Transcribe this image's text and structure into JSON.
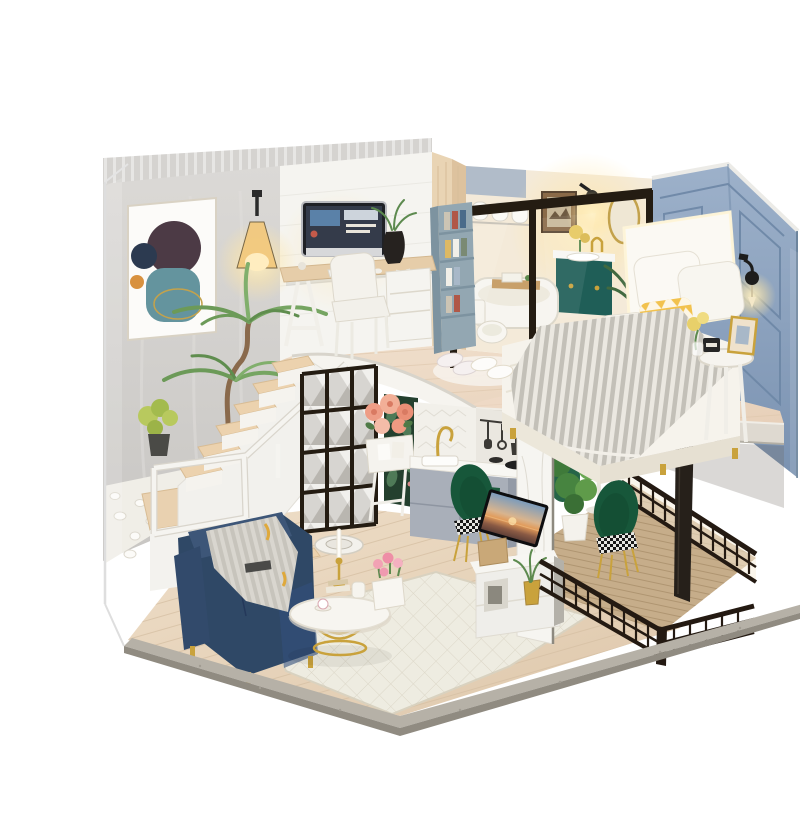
{
  "meta": {
    "domain": "natural-image",
    "subject": "Product photo of a DIY miniature dollhouse: modern two-story loft diorama with living room, kitchen, balcony, stairs, study, bathroom and bedroom, inside a clear acrylic display case on a white background",
    "background": "#ffffff"
  },
  "palette": {
    "background": "#ffffff",
    "wall_gray": "#d3d1ce",
    "wall_white": "#f5f4f0",
    "wall_wood": "#e9d4b4",
    "wall_blue": "#8099b8",
    "floor_wood_upper": "#ecd9c6",
    "floor_wood_lower": "#e6d2ba",
    "fascia_white": "#f6f4ef",
    "sofa_navy": "#2f4866",
    "vanity_teal": "#1f5e57",
    "chair_green": "#17573a",
    "metal_gold": "#c9a23c",
    "lattice_black": "#241c12",
    "railing_black": "#241a12",
    "lamp_glow": "#ffe6a6",
    "blanket_gray": "#b9b6ae",
    "pillow_yellow": "#f2c24e",
    "plant_green": "#6c9a58",
    "rug_cream": "#eeece1",
    "rose_pink": "#f2af97",
    "tulip_pink": "#f2a2b4",
    "deck_wood": "#c6ad8a",
    "base_gray": "#b6b1a7",
    "tv_sky": "#7d9cbb",
    "tv_sunset": "#e29a58"
  },
  "rooms": {
    "upper": [
      "study",
      "bathroom",
      "bedroom"
    ],
    "lower": [
      "living-room",
      "kitchen",
      "dining-balcony",
      "stair-garden"
    ]
  },
  "objects": [
    {
      "id": "acrylic-cover",
      "label": "clear acrylic dust cover"
    },
    {
      "id": "left-wall",
      "label": "gray textured wall"
    },
    {
      "id": "wall-art",
      "label": "abstract framed art"
    },
    {
      "id": "wall-lamp-left",
      "label": "glowing wall lamp"
    },
    {
      "id": "study-desk",
      "label": "trestle desk"
    },
    {
      "id": "imac",
      "label": "desktop computer"
    },
    {
      "id": "desk-chair",
      "label": "white upholstered chair"
    },
    {
      "id": "bookshelf",
      "label": "open bookshelf"
    },
    {
      "id": "bathroom",
      "label": "glass partition bathroom"
    },
    {
      "id": "bathtub",
      "label": "white bathtub with tray"
    },
    {
      "id": "toilet",
      "label": "toilet"
    },
    {
      "id": "vanity",
      "label": "teal floating vanity"
    },
    {
      "id": "mirror",
      "label": "gold framed mirror"
    },
    {
      "id": "blue-wall",
      "label": "slate blue panel wall"
    },
    {
      "id": "bed",
      "label": "white platform bed"
    },
    {
      "id": "knit-blanket",
      "label": "gray knitted throw"
    },
    {
      "id": "pillows",
      "label": "white and yellow pillows"
    },
    {
      "id": "side-table",
      "label": "round bedside table"
    },
    {
      "id": "slippers",
      "label": "fluffy slippers"
    },
    {
      "id": "stairs",
      "label": "open wooden staircase"
    },
    {
      "id": "landing-railing",
      "label": "white stair railing"
    },
    {
      "id": "pebble-garden",
      "label": "white pebble indoor garden"
    },
    {
      "id": "yucca-plant",
      "label": "tall green plant"
    },
    {
      "id": "lattice-screen",
      "label": "black lattice mirror screen"
    },
    {
      "id": "flower-stand",
      "label": "rose flower stand"
    },
    {
      "id": "leaf-panel",
      "label": "tropical leaf wallpaper panel"
    },
    {
      "id": "kitchen",
      "label": "gray kitchen with gold faucet"
    },
    {
      "id": "marble-partition",
      "label": "white marble TV wall"
    },
    {
      "id": "tv",
      "label": "flat screen TV with sunset"
    },
    {
      "id": "media-console",
      "label": "white media console"
    },
    {
      "id": "dining-table",
      "label": "round white dining table"
    },
    {
      "id": "velvet-chairs",
      "label": "green velvet chairs"
    },
    {
      "id": "balcony",
      "label": "black railing balcony"
    },
    {
      "id": "sofa",
      "label": "navy blue sofa"
    },
    {
      "id": "throw-blanket",
      "label": "striped sofa throw"
    },
    {
      "id": "coffee-table",
      "label": "gold wire coffee table"
    },
    {
      "id": "tulip-vase",
      "label": "pink tulip planter"
    },
    {
      "id": "robot-vacuum",
      "label": "robot vacuum"
    },
    {
      "id": "rug",
      "label": "diamond pattern rug"
    },
    {
      "id": "base-platform",
      "label": "wooden display base"
    }
  ]
}
